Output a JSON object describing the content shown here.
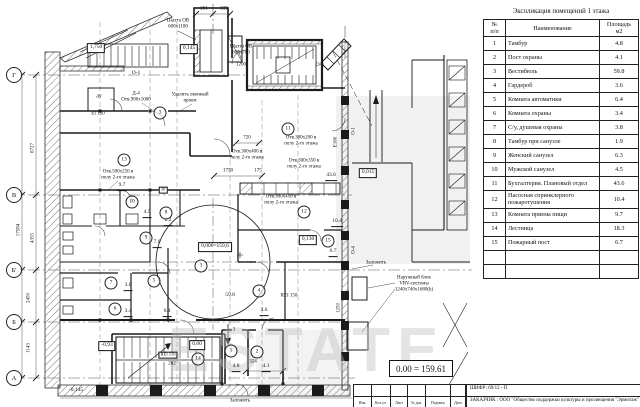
{
  "explication": {
    "title": "Экспликация помещений 1 этажа",
    "header": {
      "num1": "№",
      "num2": "п/п",
      "name": "Наименование",
      "area1": "Площадь",
      "area2": "м2"
    },
    "rows": [
      {
        "n": "1",
        "name": "Тамбур",
        "area": "4.8"
      },
      {
        "n": "2",
        "name": "Пост охраны",
        "area": "4.1"
      },
      {
        "n": "3",
        "name": "Вестибюль",
        "area": "59.8"
      },
      {
        "n": "4",
        "name": "Гардероб",
        "area": "3.6"
      },
      {
        "n": "5",
        "name": "Комната автоматики",
        "area": "6.4"
      },
      {
        "n": "6",
        "name": "Комната охраны",
        "area": "3.4"
      },
      {
        "n": "7",
        "name": "С/у, душевая охраны",
        "area": "3.8"
      },
      {
        "n": "8",
        "name": "Тамбур при санузле",
        "area": "1.9"
      },
      {
        "n": "9",
        "name": "Женский санузел",
        "area": "6.3"
      },
      {
        "n": "10",
        "name": "Мужской санузел",
        "area": "4.5"
      },
      {
        "n": "11",
        "name": "Бухгалтерия. Плановый отдел",
        "area": "43.6"
      },
      {
        "n": "12",
        "name": "Насосная спринклерного пожаротушения",
        "area": "10.4"
      },
      {
        "n": "13",
        "name": "Комната приема пищи",
        "area": "9.7"
      },
      {
        "n": "14",
        "name": "Лестница",
        "area": "18.3"
      },
      {
        "n": "15",
        "name": "Пожарный пост",
        "area": "6.7"
      },
      {
        "n": "",
        "name": "",
        "area": ""
      },
      {
        "n": "",
        "name": "",
        "area": ""
      }
    ]
  },
  "level_box": {
    "text": "0.00 = 159.61"
  },
  "title_block": {
    "cipher": "ШИФР: 69/12 - П",
    "customer": "ЗАКАЗЧИК :  ООО \"Общество поддержки культуры и просвещения \"Эрмитаж\"",
    "stamp_cols": [
      "Изм.",
      "Кол.уч.",
      "Лист",
      "№ док.",
      "Подпись",
      "Дата"
    ]
  },
  "watermark": "ESTATE",
  "plan": {
    "axes": [
      {
        "n": "Г",
        "x": 14,
        "y": 75
      },
      {
        "n": "В",
        "x": 14,
        "y": 195
      },
      {
        "n": "Б'",
        "x": 14,
        "y": 270
      },
      {
        "n": "Б",
        "x": 14,
        "y": 322
      },
      {
        "n": "А",
        "x": 14,
        "y": 378
      }
    ],
    "rooms": [
      {
        "n": "3",
        "x": 160,
        "y": 113
      },
      {
        "n": "13",
        "x": 124,
        "y": 160
      },
      {
        "n": "10",
        "x": 132,
        "y": 202
      },
      {
        "n": "8",
        "x": 166,
        "y": 213
      },
      {
        "n": "9",
        "x": 146,
        "y": 238
      },
      {
        "n": "11",
        "x": 288,
        "y": 129
      },
      {
        "n": "12",
        "x": 304,
        "y": 212
      },
      {
        "n": "15",
        "x": 328,
        "y": 241
      },
      {
        "n": "3",
        "x": 201,
        "y": 266
      },
      {
        "n": "5",
        "x": 154,
        "y": 281
      },
      {
        "n": "7",
        "x": 111,
        "y": 283
      },
      {
        "n": "4",
        "x": 259,
        "y": 291
      },
      {
        "n": "6",
        "x": 115,
        "y": 309
      },
      {
        "n": "14",
        "x": 198,
        "y": 359
      },
      {
        "n": "1",
        "x": 231,
        "y": 351
      },
      {
        "n": "2",
        "x": 257,
        "y": 352
      }
    ],
    "texts": [
      {
        "t": "Шахта ОВ",
        "x": 178,
        "y": 21
      },
      {
        "t": "600х1100",
        "x": 178,
        "y": 27
      },
      {
        "t": "261",
        "x": 204,
        "y": 9
      },
      {
        "t": "339",
        "x": 224,
        "y": 9
      },
      {
        "t": "Шахта ОВ",
        "x": 241,
        "y": 47
      },
      {
        "t": "600х700",
        "x": 241,
        "y": 53
      },
      {
        "t": "1200",
        "x": 241,
        "y": 65
      },
      {
        "t": "1,750",
        "x": 96,
        "y": 48,
        "c": "b"
      },
      {
        "t": "0,145",
        "x": 189,
        "y": 49,
        "c": "b"
      },
      {
        "t": "О-1",
        "x": 136,
        "y": 74,
        "c": "m"
      },
      {
        "t": "О-1",
        "x": 320,
        "y": 66,
        "c": "m"
      },
      {
        "t": "ду",
        "x": 99,
        "y": 97,
        "c": "m"
      },
      {
        "t": "EI 150",
        "x": 98,
        "y": 114
      },
      {
        "t": "Д-4",
        "x": 136,
        "y": 94
      },
      {
        "t": "Отв.900х1000",
        "x": 136,
        "y": 100
      },
      {
        "t": "Удалить оконный",
        "x": 190,
        "y": 95
      },
      {
        "t": "проем",
        "x": 190,
        "y": 101
      },
      {
        "t": "Отв.500х250 в",
        "x": 118,
        "y": 172
      },
      {
        "t": "полу 2-го этажа",
        "x": 118,
        "y": 178
      },
      {
        "t": "9.7",
        "x": 122,
        "y": 187,
        "c": "u"
      },
      {
        "t": "30",
        "x": 163,
        "y": 190,
        "c": "b2"
      },
      {
        "t": "720",
        "x": 247,
        "y": 138
      },
      {
        "t": "1750",
        "x": 228,
        "y": 171
      },
      {
        "t": "175",
        "x": 258,
        "y": 171
      },
      {
        "t": "Отв.300х400 в",
        "x": 247,
        "y": 152
      },
      {
        "t": "полу 2-го этажа",
        "x": 247,
        "y": 158
      },
      {
        "t": "Отв.300х200 в",
        "x": 301,
        "y": 138
      },
      {
        "t": "полу 2-го этажа",
        "x": 301,
        "y": 144
      },
      {
        "t": "Отв.300х350 в",
        "x": 304,
        "y": 161
      },
      {
        "t": "полу 2-го этажа",
        "x": 304,
        "y": 167
      },
      {
        "t": "Отв.300х450 в",
        "x": 281,
        "y": 197
      },
      {
        "t": "полу 2-го этажа",
        "x": 281,
        "y": 203
      },
      {
        "t": "43.6",
        "x": 331,
        "y": 177,
        "c": "u"
      },
      {
        "t": "0,015",
        "x": 368,
        "y": 173,
        "c": "b"
      },
      {
        "t": "10.4",
        "x": 337,
        "y": 223,
        "c": "u"
      },
      {
        "t": "0,130",
        "x": 308,
        "y": 240,
        "c": "b"
      },
      {
        "t": "6.7",
        "x": 333,
        "y": 253,
        "c": "u"
      },
      {
        "t": "0,000=159,6",
        "x": 215,
        "y": 247,
        "c": "b"
      },
      {
        "t": "59.8",
        "x": 230,
        "y": 296,
        "c": "m"
      },
      {
        "t": "3.8",
        "x": 128,
        "y": 287,
        "c": "u"
      },
      {
        "t": "2.2",
        "x": 168,
        "y": 222,
        "c": "u"
      },
      {
        "t": "7.0",
        "x": 157,
        "y": 244,
        "c": "u"
      },
      {
        "t": "4.5",
        "x": 147,
        "y": 214,
        "c": "u"
      },
      {
        "t": "3.4",
        "x": 128,
        "y": 313,
        "c": "u"
      },
      {
        "t": "6.4",
        "x": 167,
        "y": 313,
        "c": "u"
      },
      {
        "t": "3.6",
        "x": 264,
        "y": 312,
        "c": "u"
      },
      {
        "t": "4.8",
        "x": 236,
        "y": 368,
        "c": "u"
      },
      {
        "t": "324",
        "x": 253,
        "y": 362
      },
      {
        "t": "4.1",
        "x": 266,
        "y": 368,
        "c": "u"
      },
      {
        "t": "REI 150",
        "x": 168,
        "y": 355,
        "c": "b2"
      },
      {
        "t": "282",
        "x": 172,
        "y": 364
      },
      {
        "t": "REI 150",
        "x": 289,
        "y": 296
      },
      {
        "t": "0,00",
        "x": 197,
        "y": 345,
        "c": "b"
      },
      {
        "t": "-0,93",
        "x": 107,
        "y": 346,
        "c": "b"
      },
      {
        "t": "-0,145",
        "x": 76,
        "y": 391,
        "c": "m"
      },
      {
        "t": "3",
        "x": 234,
        "y": 330
      },
      {
        "t": "Заложить",
        "x": 376,
        "y": 263
      },
      {
        "t": "Заложить",
        "x": 240,
        "y": 401
      },
      {
        "t": "Наружный блок",
        "x": 414,
        "y": 278
      },
      {
        "t": "VRV-системы",
        "x": 414,
        "y": 284
      },
      {
        "t": "1240х740х1680(h)",
        "x": 414,
        "y": 290
      },
      {
        "t": "1250",
        "x": 339,
        "y": 308,
        "c": "r"
      },
      {
        "t": "17584",
        "x": 19,
        "y": 230,
        "c": "r"
      },
      {
        "t": "6727",
        "x": 33,
        "y": 148,
        "c": "r"
      },
      {
        "t": "4355",
        "x": 33,
        "y": 238,
        "c": "r"
      },
      {
        "t": "2450",
        "x": 29,
        "y": 298,
        "c": "r"
      },
      {
        "t": "1143",
        "x": 29,
        "y": 348,
        "c": "r"
      },
      {
        "t": "О-1",
        "x": 354,
        "y": 131,
        "c": "r"
      },
      {
        "t": "Е160",
        "x": 336,
        "y": 142,
        "c": "r"
      },
      {
        "t": "О-4",
        "x": 354,
        "y": 250,
        "c": "r"
      }
    ]
  }
}
